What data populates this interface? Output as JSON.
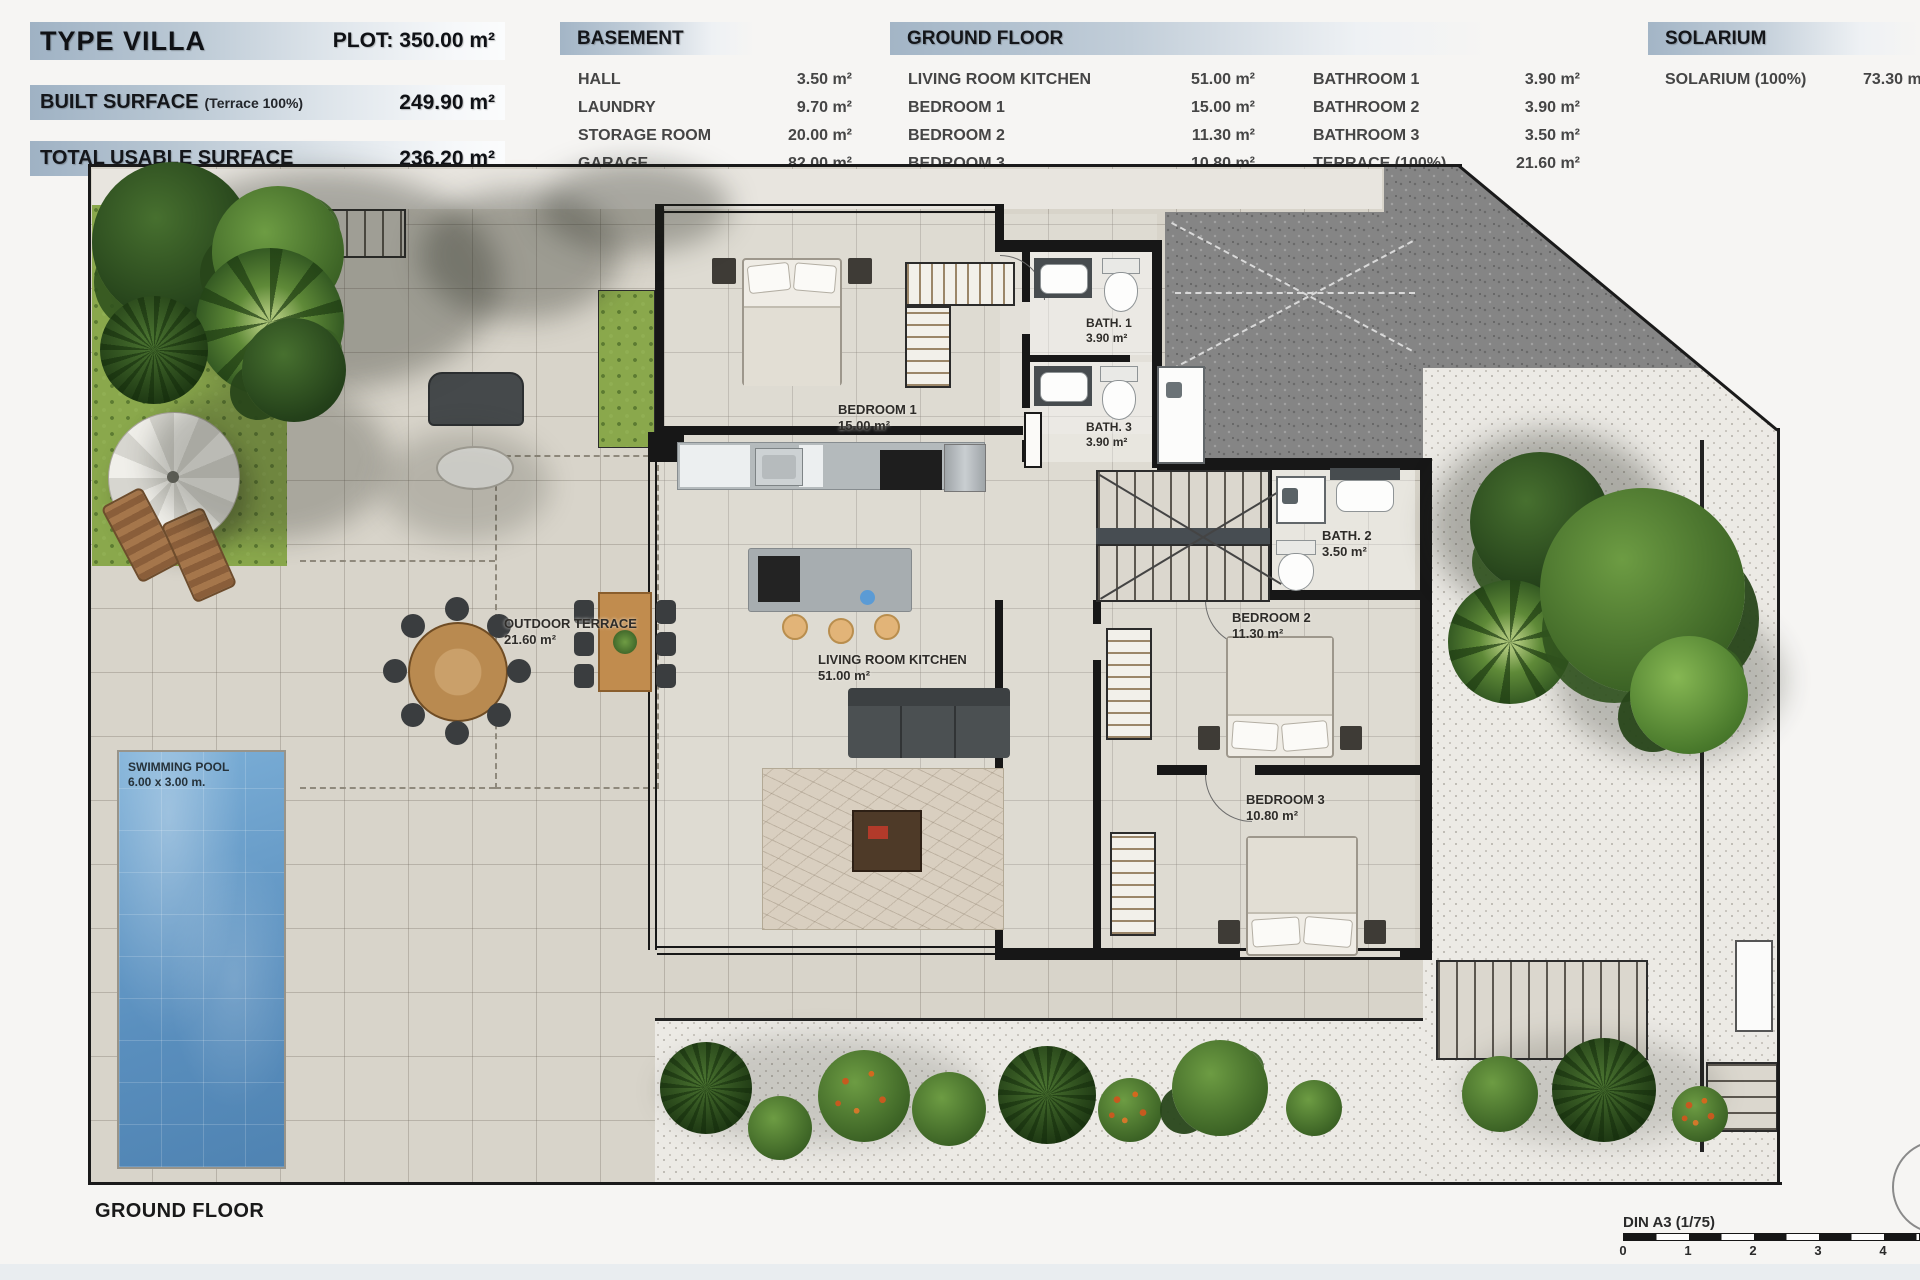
{
  "header": {
    "type_villa": {
      "label": "TYPE VILLA",
      "plot": "PLOT: 350.00 m²"
    },
    "built_surface": {
      "label": "BUILT SURFACE",
      "note": "(Terrace 100%)",
      "value": "249.90 m²"
    },
    "total_usable": {
      "label": "TOTAL USABLE SURFACE",
      "value": "236.20 m²"
    }
  },
  "tables": {
    "basement": {
      "title": "BASEMENT",
      "rows": [
        {
          "label": "HALL",
          "value": "3.50 m²"
        },
        {
          "label": "LAUNDRY",
          "value": "9.70 m²"
        },
        {
          "label": "STORAGE ROOM",
          "value": "20.00 m²"
        },
        {
          "label": "GARAGE",
          "value": "82.00 m²"
        }
      ]
    },
    "ground_floor": {
      "title": "GROUND FLOOR",
      "left_rows": [
        {
          "label": "LIVING ROOM KITCHEN",
          "value": "51.00 m²"
        },
        {
          "label": "BEDROOM 1",
          "value": "15.00 m²"
        },
        {
          "label": "BEDROOM 2",
          "value": "11.30 m²"
        },
        {
          "label": "BEDROOM 3",
          "value": "10.80 m²"
        }
      ],
      "right_rows": [
        {
          "label": "BATHROOM 1",
          "value": "3.90 m²"
        },
        {
          "label": "BATHROOM 2",
          "value": "3.90 m²"
        },
        {
          "label": "BATHROOM 3",
          "value": "3.50 m²"
        },
        {
          "label": "TERRACE (100%)",
          "value": "21.60 m²"
        }
      ]
    },
    "solarium": {
      "title": "SOLARIUM",
      "rows": [
        {
          "label": "SOLARIUM (100%)",
          "value": "73.30 m²"
        }
      ]
    }
  },
  "plan": {
    "labels": {
      "bedroom1": {
        "name": "BEDROOM 1",
        "area": "15.00 m²"
      },
      "bath1": {
        "name": "BATH. 1",
        "area": "3.90 m²"
      },
      "bath3": {
        "name": "BATH. 3",
        "area": "3.90 m²"
      },
      "bath2": {
        "name": "BATH. 2",
        "area": "3.50 m²"
      },
      "bedroom2": {
        "name": "BEDROOM 2",
        "area": "11.30 m²"
      },
      "bedroom3": {
        "name": "BEDROOM 3",
        "area": "10.80 m²"
      },
      "living": {
        "name": "LIVING ROOM KITCHEN",
        "area": "51.00 m²"
      },
      "outdoor_terrace": {
        "name": "OUTDOOR TERRACE",
        "area": "21.60 m²"
      },
      "pool": {
        "name": "SWIMMING POOL",
        "area": "6.00 x 3.00 m."
      }
    }
  },
  "footer": {
    "title": "GROUND FLOOR",
    "scale_label": "DIN A3 (1/75)",
    "scale_ticks": [
      "0",
      "1",
      "2",
      "3",
      "4"
    ]
  },
  "colors": {
    "header_gradient_start": "#9fb2c4",
    "wall": "#171717",
    "pavement": "#d8d4ca",
    "grass": "#8aa84c",
    "pool_water": "#5a8fbe",
    "gravel_dark": "#858585",
    "gravel_light": "#eceae5"
  }
}
